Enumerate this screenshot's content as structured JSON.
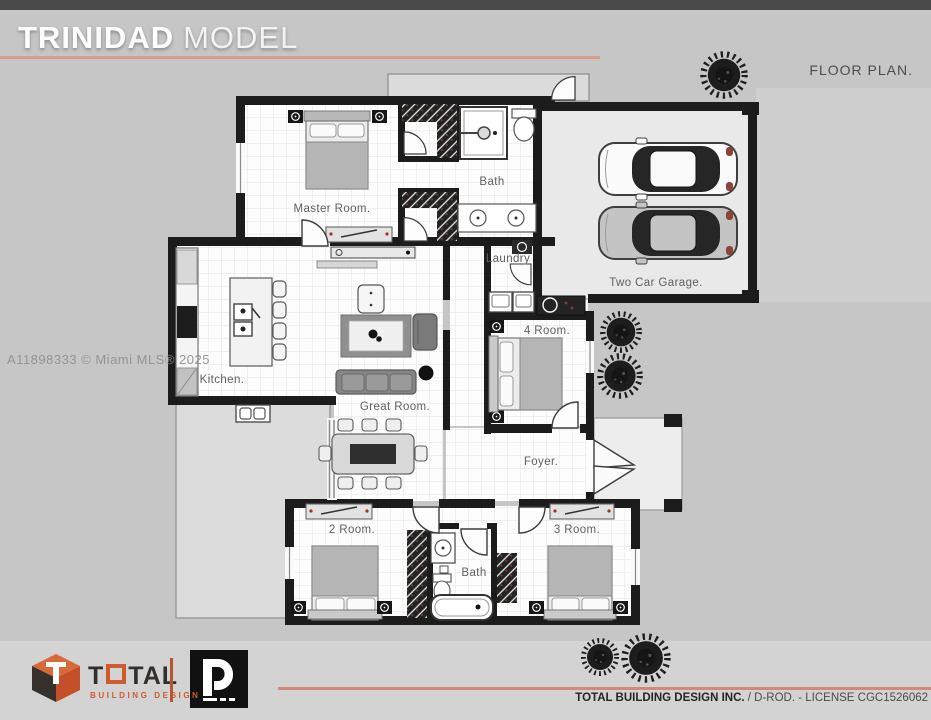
{
  "header": {
    "title_primary": "TRINIDAD",
    "title_secondary": "MODEL",
    "plan_label": "FLOOR PLAN.",
    "accent_color": "#db9c8e",
    "topbar_color": "#4b4b4b"
  },
  "watermark": "A11898333 © Miami MLS® 2025",
  "rooms": {
    "master": "Master Room.",
    "master_bath": "Bath",
    "garage": "Two Car Garage.",
    "laundry": "Laundry",
    "room4": "4 Room.",
    "kitchen": "Kitchen.",
    "great_room": "Great Room.",
    "foyer": "Foyer.",
    "room2": "2 Room.",
    "bath2": "Bath",
    "room3": "3 Room."
  },
  "footer": {
    "brand_t": "T",
    "brand_tal": "TAL",
    "brand_sub": "BUILDING DESIGN",
    "brand_orange": "#cf5a2e",
    "credit_bold": "TOTAL BUILDING DESIGN INC.",
    "credit_rest": " / D-ROD. - LICENSE CGC1526062"
  },
  "colors": {
    "wall": "#1c1c1c",
    "background": "#c6c6c6",
    "patio": "#dcdcdc",
    "accent_line": "#d4887a"
  }
}
